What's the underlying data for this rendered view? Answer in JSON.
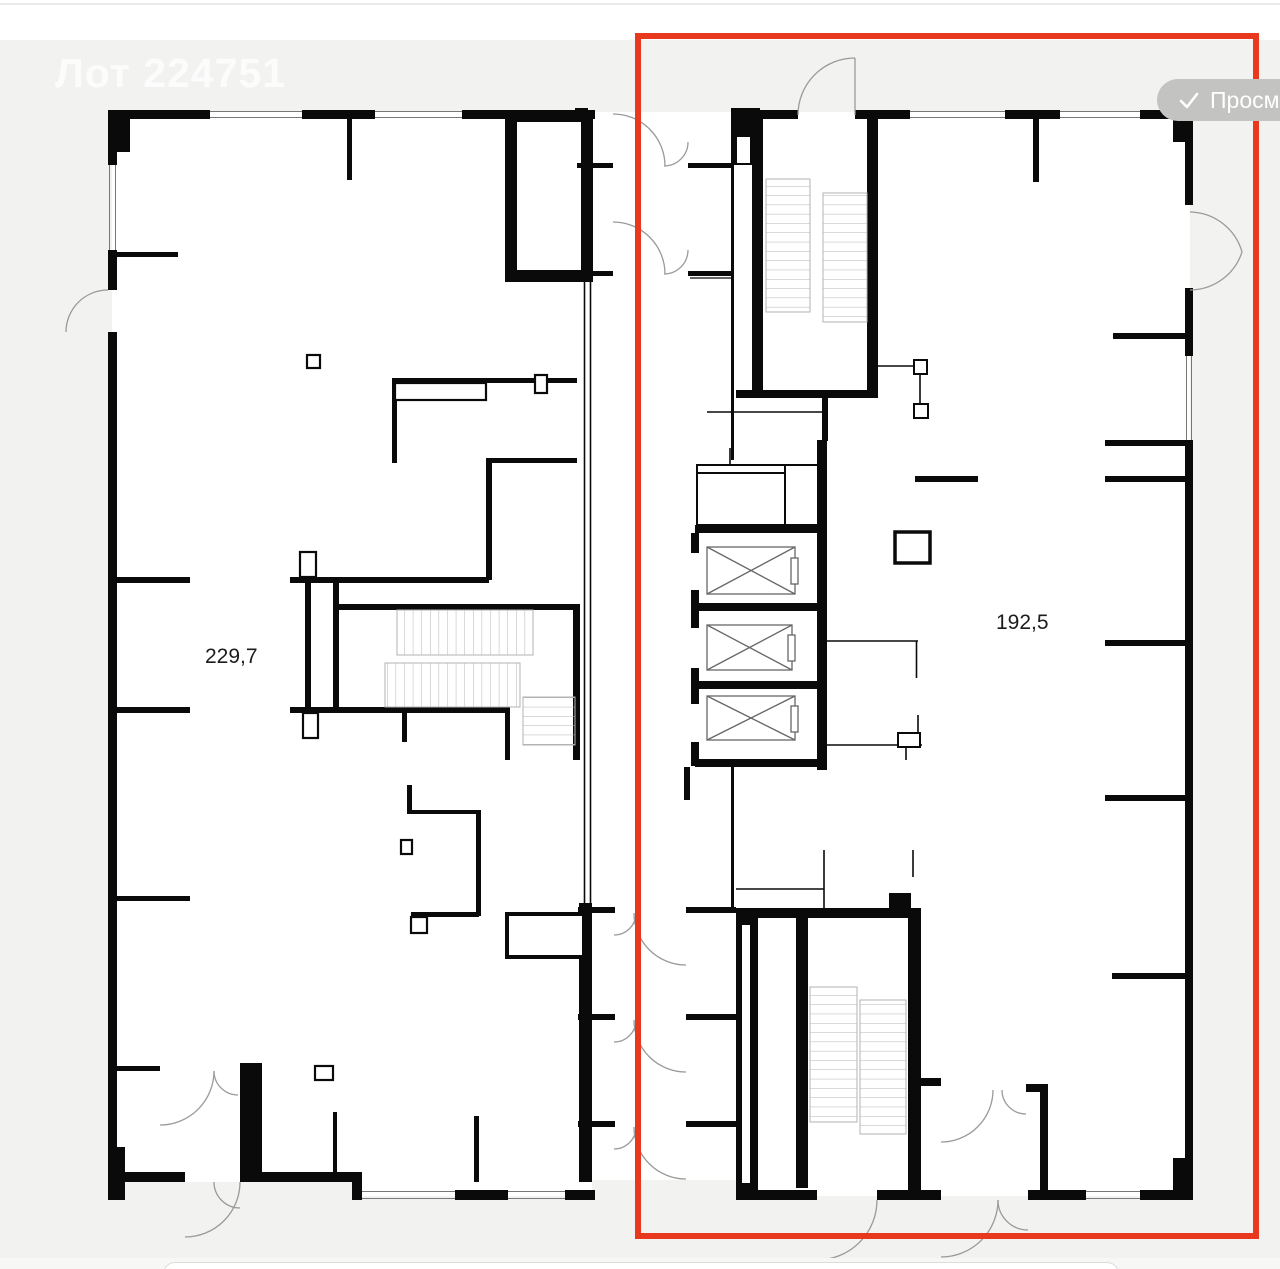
{
  "header": {
    "watermark": "Лот 224751"
  },
  "badge": {
    "label": "Просмотрено",
    "icon": "checkmark-icon"
  },
  "plan": {
    "left_unit": {
      "area_label": "229,7",
      "selected": false
    },
    "right_unit": {
      "area_label": "192,5",
      "selected": true
    },
    "features": [
      "stairs",
      "elevators",
      "door-swings",
      "windows"
    ]
  },
  "colors": {
    "accent_red": "#E8391E",
    "badge_bg": "#C3C3C1",
    "badge_text": "#FFFFFF",
    "page_bg": "#F2F2F0",
    "wall": "#0A0A0A",
    "floor": "#FFFFFF",
    "detail_gray": "#9A9A9A"
  }
}
